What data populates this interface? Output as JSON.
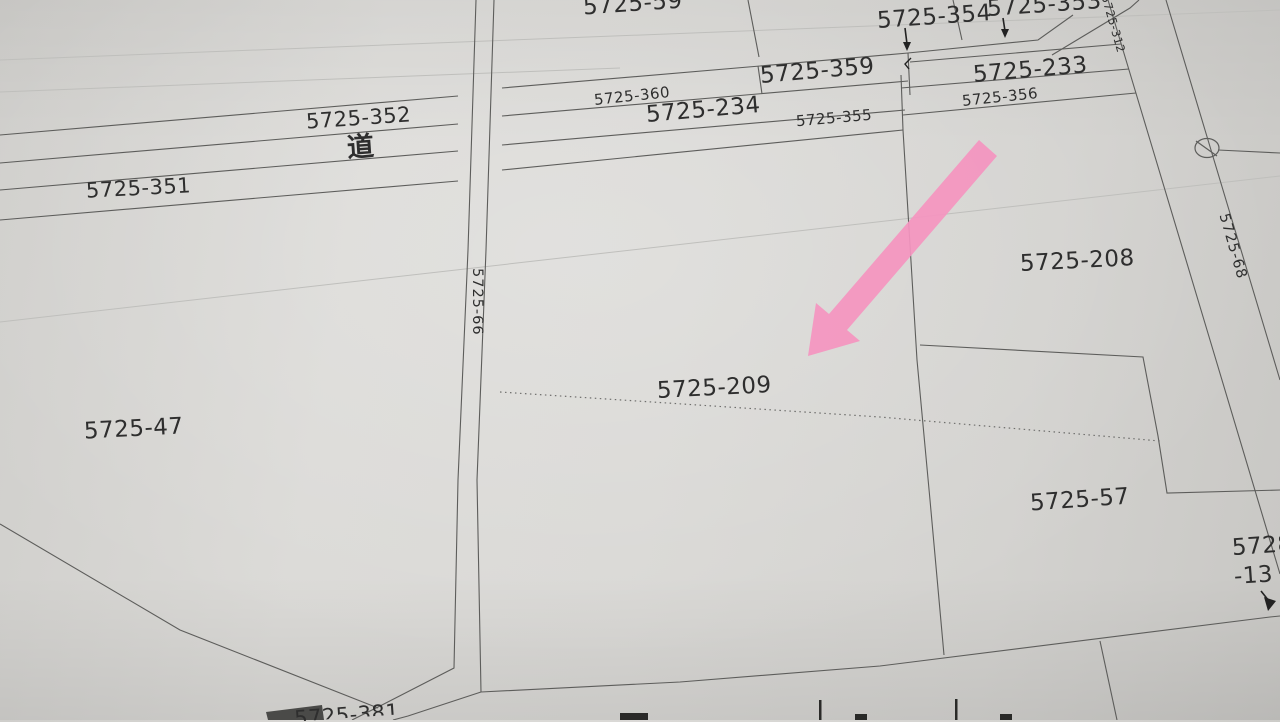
{
  "labels": {
    "p59": "5725-59",
    "p354": "5725-354",
    "p353": "5725-353",
    "p312": "5725-312",
    "p359": "5725-359",
    "p233": "5725-233",
    "p360": "5725-360",
    "p234": "5725-234",
    "p355": "5725-355",
    "p356": "5725-356",
    "p352": "5725-352",
    "road": "道",
    "p351": "5725-351",
    "p66": "5725-66",
    "p68": "5725-68",
    "p208": "5725-208",
    "p209": "5725-209",
    "p47": "5725-47",
    "p57": "5725-57",
    "p5728_line1": "5728",
    "p5728_line2": "-13",
    "p381_partial": "5725-381"
  },
  "annotation": {
    "highlight_arrow_color": "#f494bf",
    "line_color": "#5d5d5b",
    "paper_color": "#d6d5d2"
  }
}
